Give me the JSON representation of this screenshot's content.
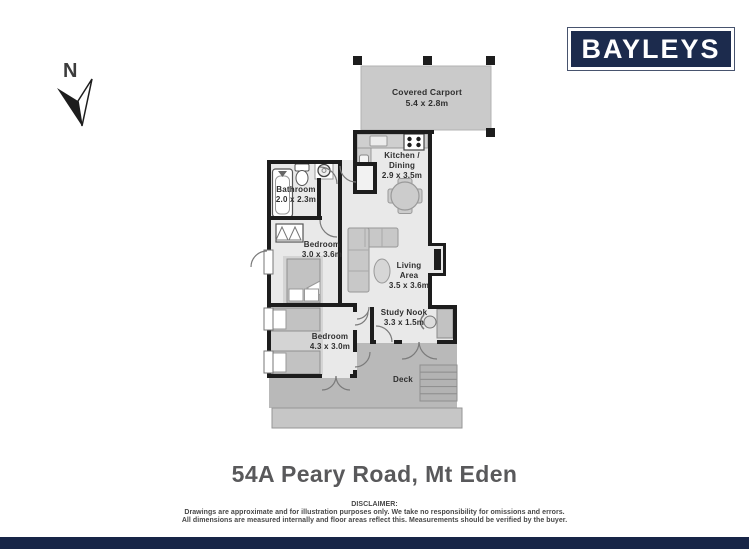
{
  "brand": {
    "logo_text": "BAYLEYS"
  },
  "compass": {
    "label": "N"
  },
  "rooms": {
    "carport": {
      "name": "Covered Carport",
      "dims": "5.4 x 2.8m"
    },
    "kitchen": {
      "name_line1": "Kitchen /",
      "name_line2": "Dining",
      "dims": "2.9 x 3.5m"
    },
    "bathroom": {
      "name": "Bathroom",
      "dims": "2.0 x 2.3m"
    },
    "bedroom1": {
      "name": "Bedroom",
      "dims": "3.0 x 3.6m"
    },
    "living": {
      "name_line1": "Living",
      "name_line2": "Area",
      "dims": "3.5 x 3.6m"
    },
    "study": {
      "name": "Study Nook",
      "dims": "3.3 x 1.5m"
    },
    "bedroom2": {
      "name": "Bedroom",
      "dims": "4.3 x 3.0m"
    },
    "deck": {
      "name": "Deck"
    }
  },
  "title": "54A Peary Road, Mt Eden",
  "disclaimer": {
    "heading": "DISCLAIMER:",
    "line1": "Drawings are approximate and for illustration purposes only. We take no responsibility for omissions and errors.",
    "line2": "All dimensions are measured internally and floor areas reflect this. Measurements should be verified by the buyer."
  },
  "colors": {
    "brand_navy": "#1c2b4d",
    "footer_bar": "#172547",
    "wall": "#1d1d1d",
    "floor": "#e9e9e9",
    "deck": "#b9b9b9",
    "carport": "#cacaca",
    "title_text": "#59595b"
  }
}
